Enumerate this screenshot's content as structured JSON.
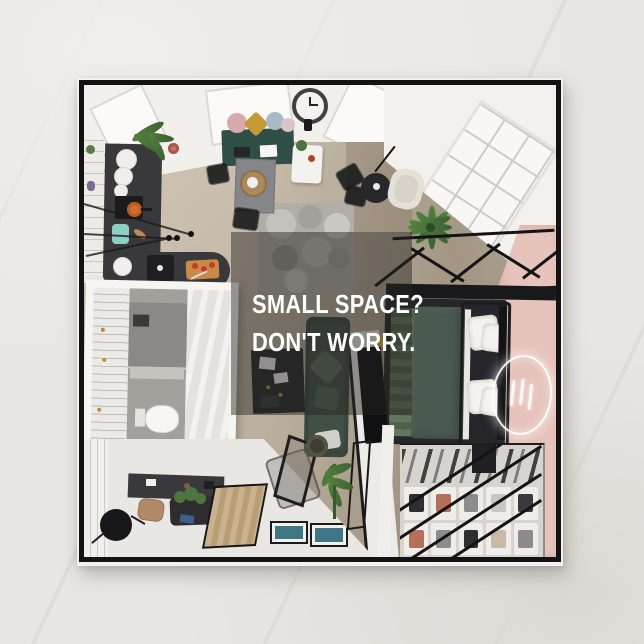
{
  "card": {
    "overlay": {
      "line1": "SMALL SPACE?",
      "line2": "DON'T WORRY.",
      "text_color": "#ffffff",
      "panel_color": "rgba(38,36,33,0.45)"
    }
  },
  "colors": {
    "page_background": "#e9e7e4",
    "card_frame": "#131313",
    "card_edge": "#f2f1ef",
    "wood_floor": "#c3b5a2",
    "ceiling_white": "#f2f0ed",
    "pink_wall": "#e6c3bb",
    "kitchen_counter": "#39393b",
    "bed_duvet": "#4b5a50",
    "sofa_green": "#39463d",
    "rug_gray": "#b1aea8",
    "closet_floor": "#d7d3cf",
    "accent_mint": "#8ccfc4",
    "accent_terracotta": "#b5705a",
    "neon_sign": "#ffffff"
  },
  "scene": {
    "elements": [
      "wall-clock",
      "skylights",
      "paned-window",
      "kitchen-counter",
      "window-seat-bench",
      "dining-table",
      "round-side-table",
      "cream-armchair",
      "pebble-rug",
      "palm-plant",
      "bathroom",
      "frosted-glass-panel",
      "work-desk",
      "green-sofa",
      "tv-partition",
      "loft-railing",
      "double-bed",
      "neon-circle-sign",
      "pink-accent-wall",
      "wardrobe-shelving",
      "entry-floor",
      "wall-shelf",
      "runner-rug",
      "floor-art-frames",
      "acrylic-chair",
      "black-chair",
      "potted-plants"
    ]
  }
}
